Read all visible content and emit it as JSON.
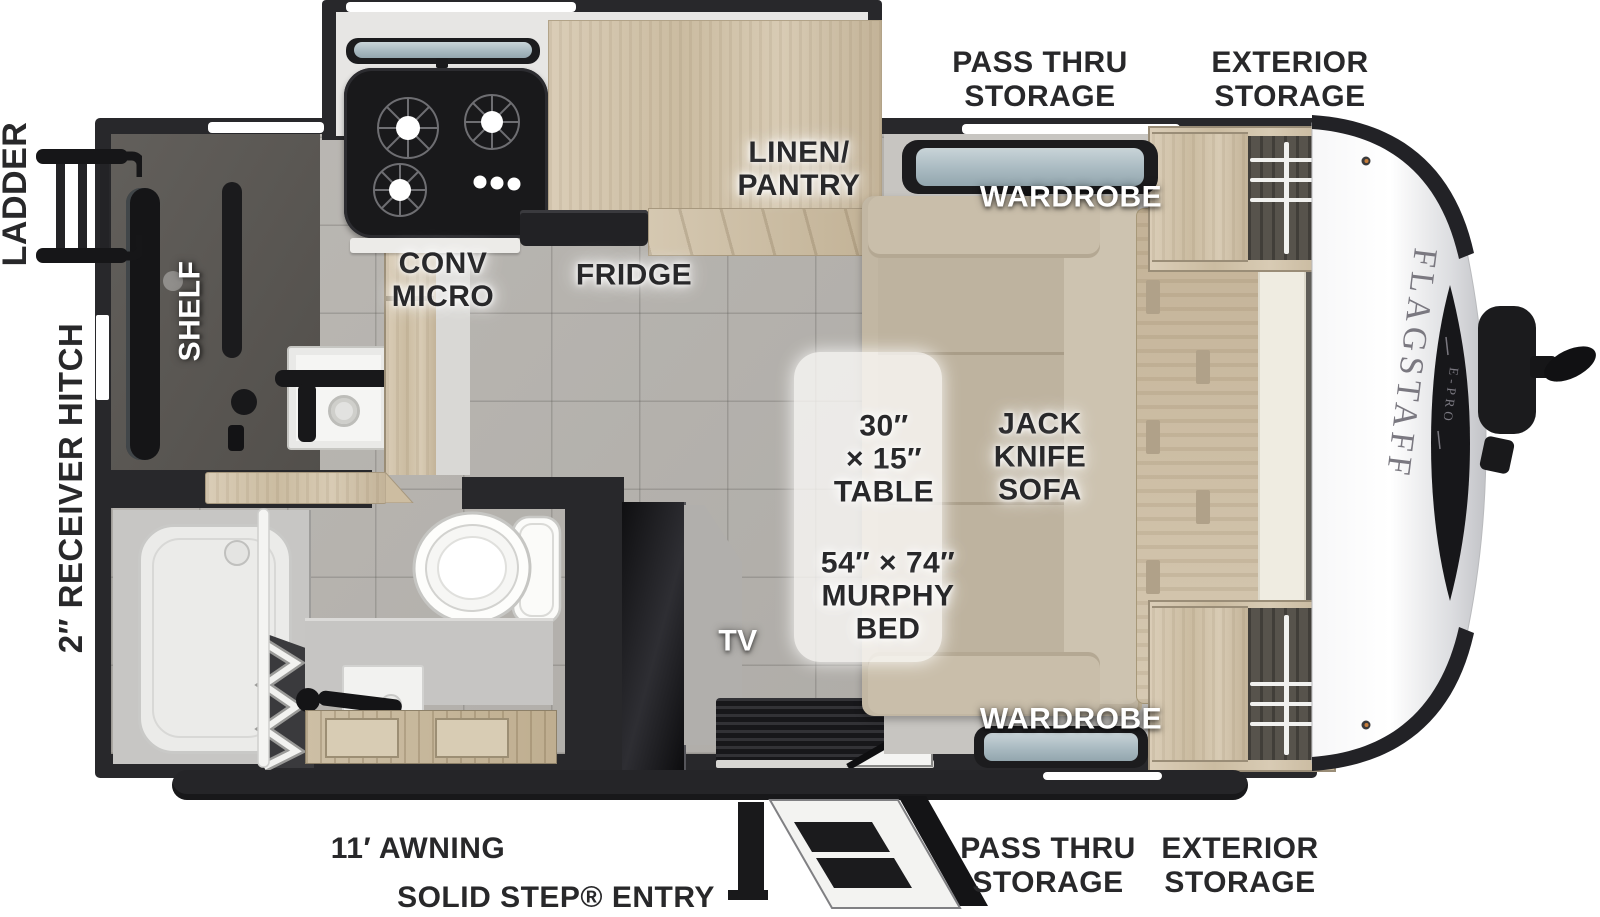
{
  "title": "Flagstaff E-Pro travel trailer floor plan",
  "brand": {
    "name": "FLAGSTAFF",
    "model": "E-PRO"
  },
  "exterior": {
    "ladder": "LADDER",
    "receiver_hitch": "2″ RECEIVER HITCH",
    "awning": "11′ AWNING",
    "entry": "SOLID STEP® ENTRY",
    "pass_thru": [
      "PASS THRU",
      "STORAGE"
    ],
    "exterior_storage": [
      "EXTERIOR",
      "STORAGE"
    ]
  },
  "interior": {
    "conv_micro": [
      "CONV",
      "MICRO"
    ],
    "fridge": "FRIDGE",
    "linen_pantry": [
      "LINEN/",
      "PANTRY"
    ],
    "shelf": "SHELF",
    "wardrobe_top": "WARDROBE",
    "wardrobe_bottom": "WARDROBE",
    "tv": "TV",
    "table": [
      "30″",
      "× 15″",
      "TABLE"
    ],
    "jack_knife_sofa": [
      "JACK",
      "KNIFE",
      "SOFA"
    ],
    "murphy_bed": [
      "54″ × 74″",
      "MURPHY",
      "BED"
    ]
  },
  "colors": {
    "wall": "#28282b",
    "floor_tile": "#b6b3ae",
    "wood_cabinet": "#d2c4aa",
    "sofa_beige": "#c2b7a3",
    "window_glass": "#aebec6",
    "appliance_black": "#19191b",
    "label_dark": "#28282a",
    "label_white": "#ffffff",
    "nose_silver": "#e8e9eb"
  }
}
